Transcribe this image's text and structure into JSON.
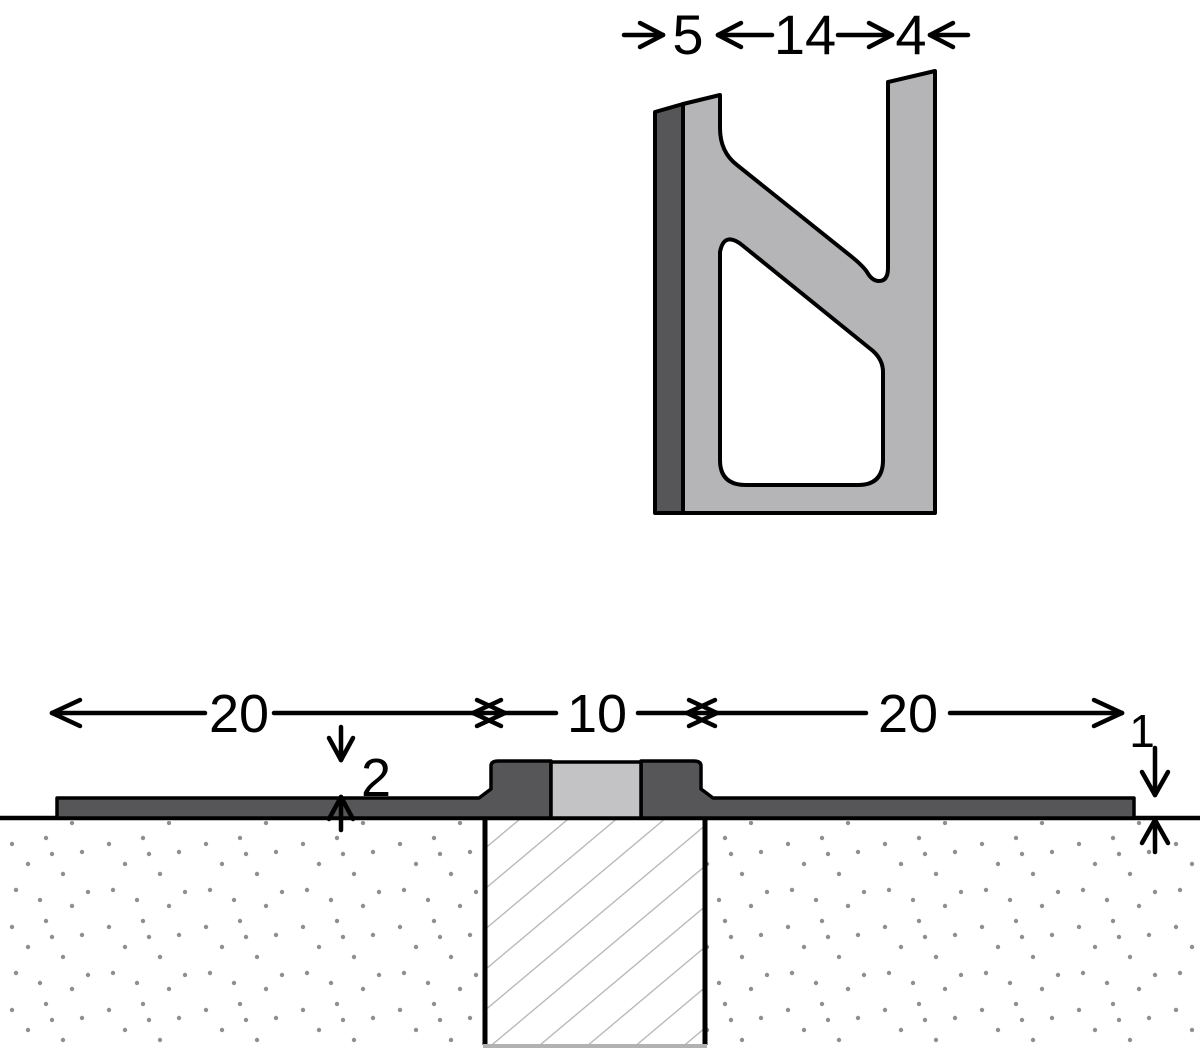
{
  "drawing": {
    "type": "technical-cross-section",
    "profile_view": {
      "description": "extruded movement joint profile cross-section",
      "dim_left_wall": "5",
      "dim_channel": "14",
      "dim_right_wall": "4"
    },
    "installed_view": {
      "description": "profile installed flush in floor over joint",
      "dim_left_flange": "20",
      "dim_joint_gap": "10",
      "dim_right_flange": "20",
      "dim_step_height": "2",
      "dim_flange_thickness": "1"
    },
    "colors": {
      "outline": "#000000",
      "profile_light_gray": "#b5b5b7",
      "profile_dark_gray": "#565658",
      "insert_gray": "#c3c3c5",
      "hatch_line_gray": "#b2b2b2",
      "stipple_dot_gray": "#8f8f8f",
      "background": "#ffffff"
    }
  }
}
